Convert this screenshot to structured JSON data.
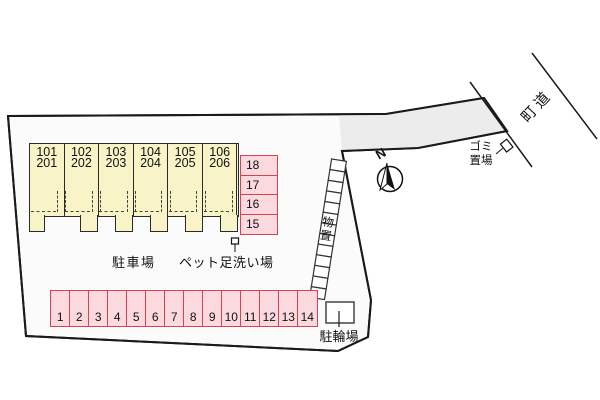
{
  "colors": {
    "building_fill": "#f8f4c8",
    "parking_fill": "#fbd9de",
    "parking_border": "#d84250",
    "boundary": "#1a1a1a",
    "driveway_fill": "#ececec"
  },
  "building": {
    "units": [
      {
        "line1": "101",
        "line2": "201"
      },
      {
        "line1": "102",
        "line2": "202"
      },
      {
        "line1": "103",
        "line2": "203"
      },
      {
        "line1": "104",
        "line2": "204"
      },
      {
        "line1": "105",
        "line2": "205"
      },
      {
        "line1": "106",
        "line2": "206"
      }
    ]
  },
  "parking_row": {
    "label": "駐車場",
    "spots": [
      "1",
      "2",
      "3",
      "4",
      "5",
      "6",
      "7",
      "8",
      "9",
      "10",
      "11",
      "12",
      "13",
      "14"
    ]
  },
  "parking_column": {
    "spots": [
      "18",
      "17",
      "16",
      "15"
    ]
  },
  "pet_wash_label": "ペット足洗い場",
  "storage": {
    "label": "物置",
    "box_count": 13
  },
  "bicycle_label": "駐輪場",
  "garbage": {
    "line1": "ゴミ",
    "line2": "置場"
  },
  "road_label": "町道",
  "compass_label": "N"
}
